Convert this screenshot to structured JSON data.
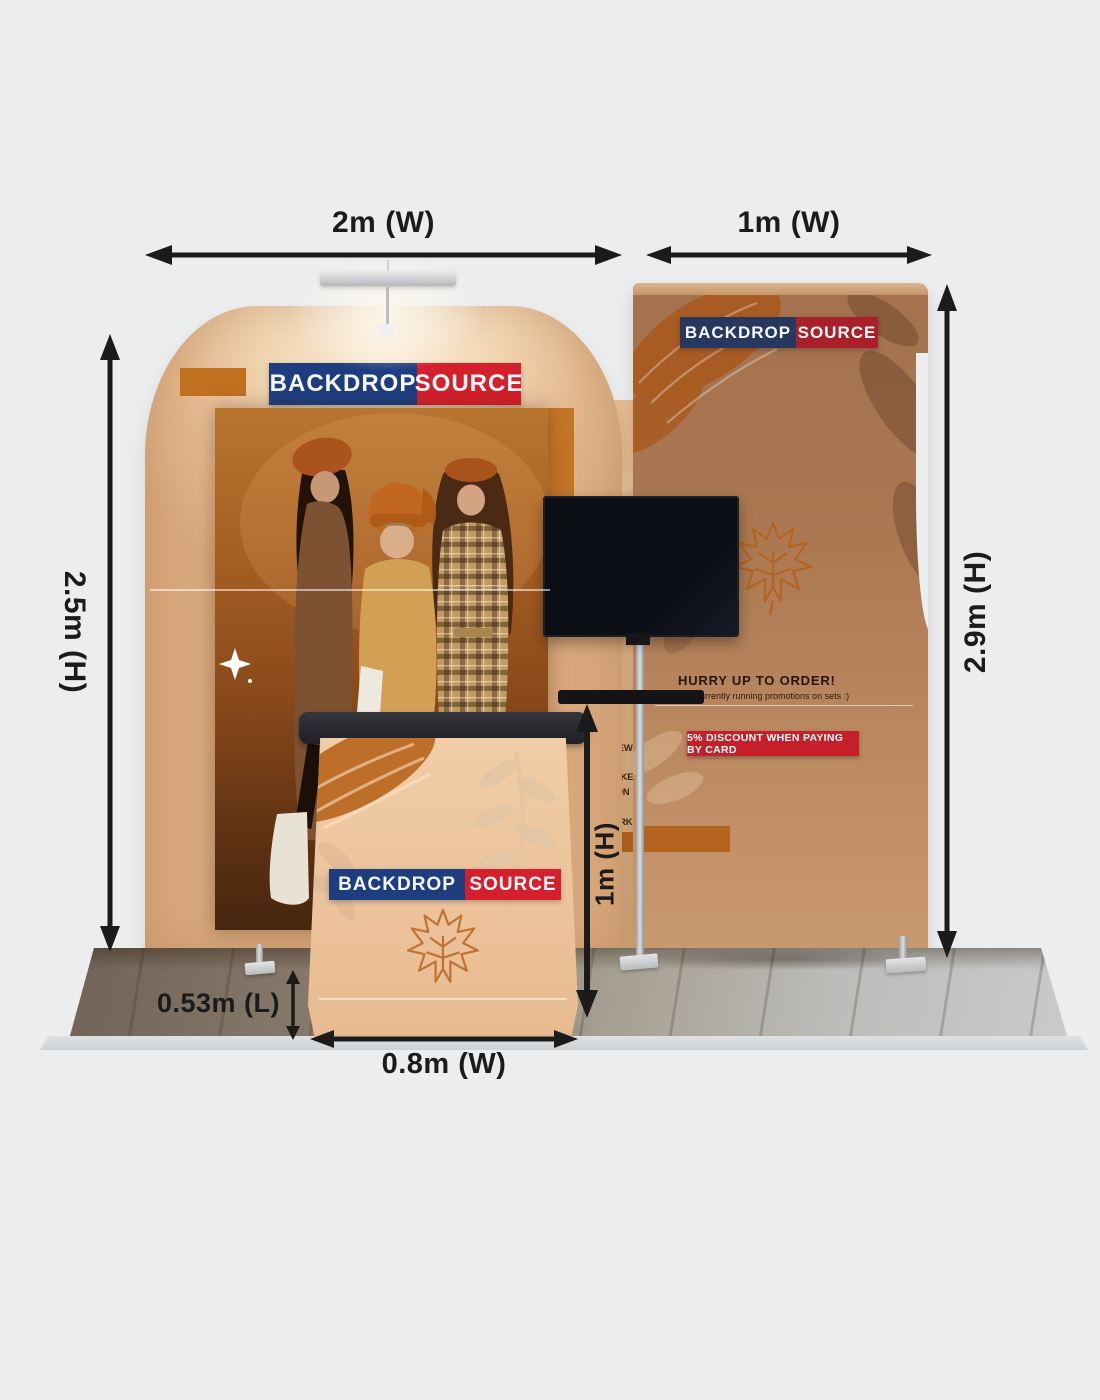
{
  "title": "Backdrop Source trade show booth kit with dimensions",
  "annotations": {
    "main_width": "2m (W)",
    "side_width": "1m (W)",
    "main_height": "2.5m (H)",
    "side_height": "2.9m (H)",
    "counter_height": "1m (H)",
    "counter_depth": "0.53m (L)",
    "counter_width": "0.8m (W)"
  },
  "brand": {
    "word_left": "BACKDROP",
    "word_right": "SOURCE"
  },
  "side_panel": {
    "headline": "HURRY UP TO ORDER!",
    "subline": "re currently running promotions on sets :)",
    "offer": "5% DISCOUNT WHEN PAYING BY CARD"
  },
  "wall_copy": {
    "lines": [
      "RIEND LUIGI",
      "RETS PUMA",
      "HOMAGE TO NEW",
      "CITY THAT HAS",
      "TH CULTURE LIKE",
      "HIS COLLECTION",
      "E TO THE PAST",
      "NT OF NEW YORK",
      "KETBALL."
    ]
  },
  "colors": {
    "background": "#ECEDEE",
    "brand_blue": "#1E3D7F",
    "brand_red": "#D3202C",
    "offer_red": "#C51F2B",
    "accent_orange": "#C0701F",
    "dimension_ink": "#1B1B1B"
  }
}
